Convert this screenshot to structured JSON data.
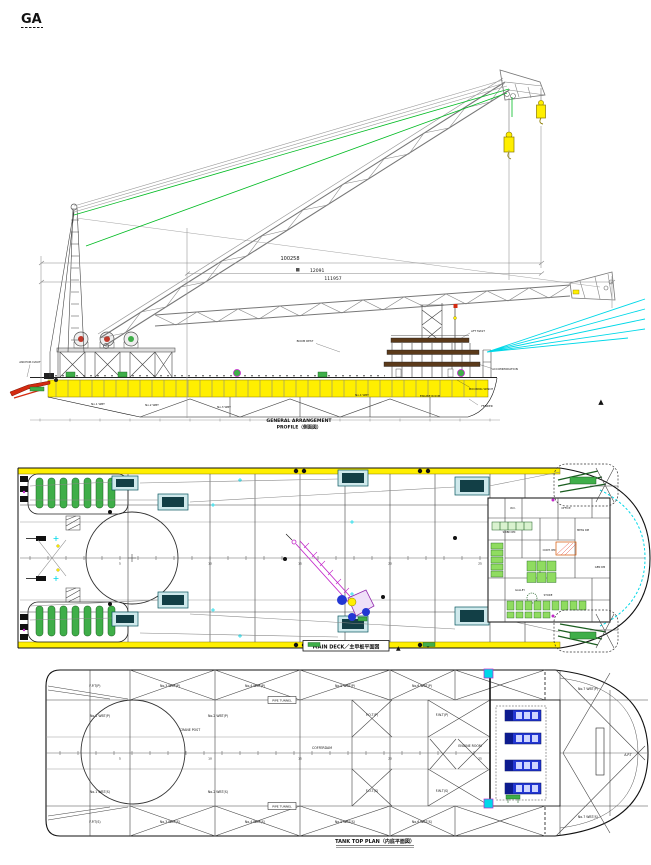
{
  "title": {
    "text": "GA"
  },
  "colors": {
    "deck_yellow": "#ffef00",
    "fender_green": "#3fae49",
    "fender_green_dark": "#1b5e20",
    "cable_green": "#00bb22",
    "guy_cyan": "#00d8e8",
    "crane_magenta": "#c226c9",
    "genset_blue": "#2337d3",
    "alert_red": "#d42a10",
    "deckband_brown": "#5b3a1a",
    "equip_green": "#8fdc60"
  },
  "profile": {
    "dim_total": "100258",
    "dim_mid": "12091",
    "dim_overall": "111957",
    "caption_line1": "GENERAL ARRANGEMENT",
    "caption_line2": "PROFILE（側面図）",
    "callouts": {
      "anchor": "ANCHOR DAVIT",
      "boom_rest": "BOOM REST",
      "mast": "AFT MAST",
      "accom": "ACCOMMODATION",
      "winch": "MOORING WINCH",
      "fender": "FENDER",
      "triangle": "▲"
    },
    "hull_labels": {
      "t1": "No.1 WBT",
      "t2": "No.2 WBT",
      "t3": "No.3 WBT",
      "t4": "No.4 WBT",
      "t5": "ENGINE ROOM"
    }
  },
  "deck_plan": {
    "caption": "MAIN DECK／主甲板平面図",
    "warning": "▲",
    "stations": {
      "s1": "5",
      "s2": "10",
      "s3": "15",
      "s4": "20",
      "s5": "25"
    },
    "rooms": {
      "r1": "W.C.",
      "r2": "SWBD RM",
      "r3": "CONT. RM",
      "r4": "OFFICE",
      "r5": "MESS RM",
      "r6": "GEN RM",
      "r7": "GALLEY",
      "r8": "STORE"
    }
  },
  "tank_plan": {
    "caption": "TANK TOP PLAN（内底平面図）",
    "stations": {
      "s1": "5",
      "s2": "10",
      "s3": "15",
      "s4": "20",
      "s5": "25"
    },
    "labels": {
      "a1": "No.3 WBT(P)",
      "a2": "No.4 WBT(P)",
      "a3": "No.5 WBT(P)",
      "a4": "No.6 WBT(P)",
      "b1": "No.3 WBT(S)",
      "b2": "No.4 WBT(S)",
      "b3": "No.5 WBT(S)",
      "b4": "No.6 WBT(S)",
      "c1": "No.1 WBT(P)",
      "c2": "No.1 WBT(S)",
      "c3": "No.2 WBT(P)",
      "c4": "No.2 WBT(S)",
      "d1": "COFFERDAM",
      "d2": "F.O.T(P)",
      "d3": "F.O.T(S)",
      "d4": "F.W.T(P)",
      "d5": "F.W.T(S)",
      "e1": "ENGINE ROOM",
      "e2": "No.7 WBT(P)",
      "e3": "No.7 WBT(S)",
      "e4": "A.P.T",
      "f1": "F.P.T(P)",
      "f2": "F.P.T(S)",
      "g1": "CRANE POST",
      "p1": "PIPE TUNNEL",
      "p2": "PIPE TUNNEL"
    }
  }
}
